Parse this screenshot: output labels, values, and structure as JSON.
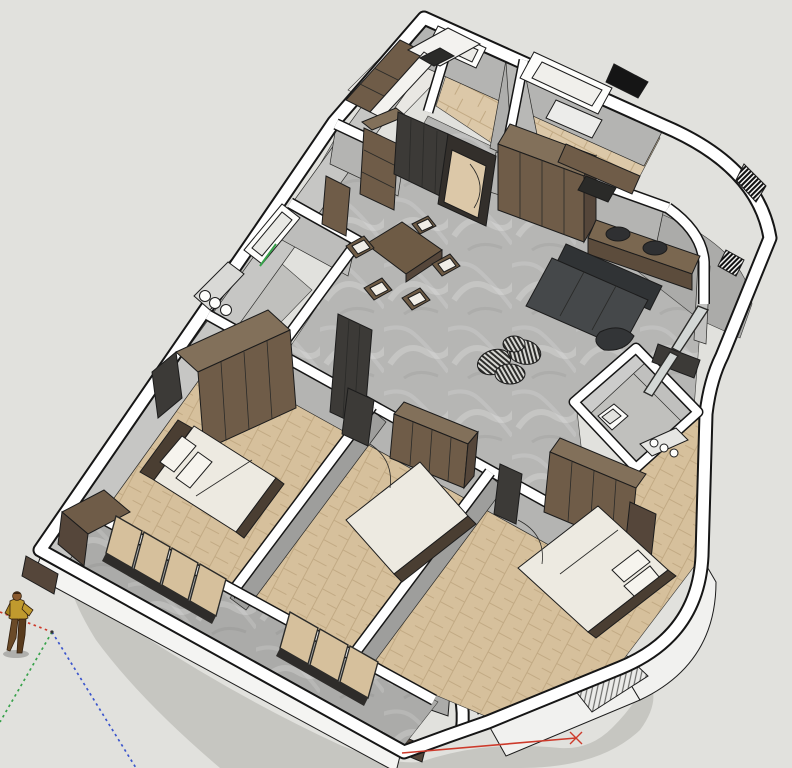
{
  "app": {
    "name": "3d-model-viewport",
    "description": "SketchUp-style cutaway axonometric 3D floor plan of a three-bedroom apartment, viewed from above with section-cut white walls",
    "visible_text": ""
  },
  "colors": {
    "bg": "#e1e1dd",
    "shadow": "#c6c6c1",
    "wallFill": "#ffffff",
    "wallLine": "#161616",
    "faceLight": "#d4d4d2",
    "faceMid": "#b4b4b2",
    "faceDark": "#9e9e9c",
    "floorConcrete": "#b6b6b4",
    "floorBalcony": "#ababa9",
    "floorTile": "#c0c0bd",
    "floorWood": "#d6c09c",
    "woodLine": "#c2aa84",
    "floorEntry": "#dcc8a8",
    "kitchenFloor": "#e9e7e3",
    "cabinet": "#6f5c48",
    "cabinetDark": "#55463a",
    "cabinetTop": "#82705a",
    "panelDark": "#3c3a37",
    "sofa": "#45484a",
    "sofaDark": "#303335",
    "bedding": "#edeae1",
    "headboard": "#4a3e32",
    "glass": "#d3d7d5",
    "axisRed": "#cd3a2b",
    "axisGreen": "#37a24a",
    "axisBlue": "#3b55cc",
    "figJacket": "#c09a2e",
    "figPants": "#6a4a28",
    "figSkin": "#8a5a2e"
  },
  "scene": {
    "rooms": [
      {
        "id": "living-dining",
        "floor": "concrete"
      },
      {
        "id": "kitchen",
        "floor": "light"
      },
      {
        "id": "entry-foyer",
        "floor": "wood-plank"
      },
      {
        "id": "study-room",
        "floor": "wood-plank"
      },
      {
        "id": "bathroom-1",
        "floor": "tile"
      },
      {
        "id": "bathroom-2",
        "floor": "tile"
      },
      {
        "id": "master-bedroom",
        "floor": "herringbone-wood"
      },
      {
        "id": "bedroom-2",
        "floor": "herringbone-wood"
      },
      {
        "id": "bedroom-3",
        "floor": "herringbone-wood"
      },
      {
        "id": "balcony-long",
        "floor": "concrete"
      },
      {
        "id": "balcony-living",
        "floor": "concrete"
      },
      {
        "id": "balcony-small",
        "floor": "concrete"
      }
    ],
    "furniture": [
      "kitchen-cabinets",
      "kitchen-counter",
      "cooktop",
      "entry-wardrobe",
      "study-desk",
      "desk-chair",
      "bookshelf",
      "tv-panel-wall",
      "side-cabinet",
      "dining-table",
      "dining-chairs",
      "sofa",
      "console-table",
      "bar-stools",
      "round-ottoman",
      "sculptural-lounge-chair",
      "corner-desk",
      "vanity-sinks",
      "toilet",
      "washbasin-counter",
      "wardrobe-master",
      "bed-master",
      "dresser",
      "wardrobe-bedroom-2",
      "bed-bedroom-2",
      "wardrobe-bedroom-3",
      "bed-bedroom-3",
      "sliding-glass-doors",
      "interior-doors",
      "planter-boxes"
    ],
    "axes": [
      {
        "name": "red-axis",
        "style": "dotted-left solid-right"
      },
      {
        "name": "green-axis",
        "style": "dotted-down solid-through-window"
      },
      {
        "name": "blue-axis",
        "style": "dotted-down"
      }
    ],
    "figure": {
      "name": "scale-figure",
      "pose": "walking"
    }
  }
}
